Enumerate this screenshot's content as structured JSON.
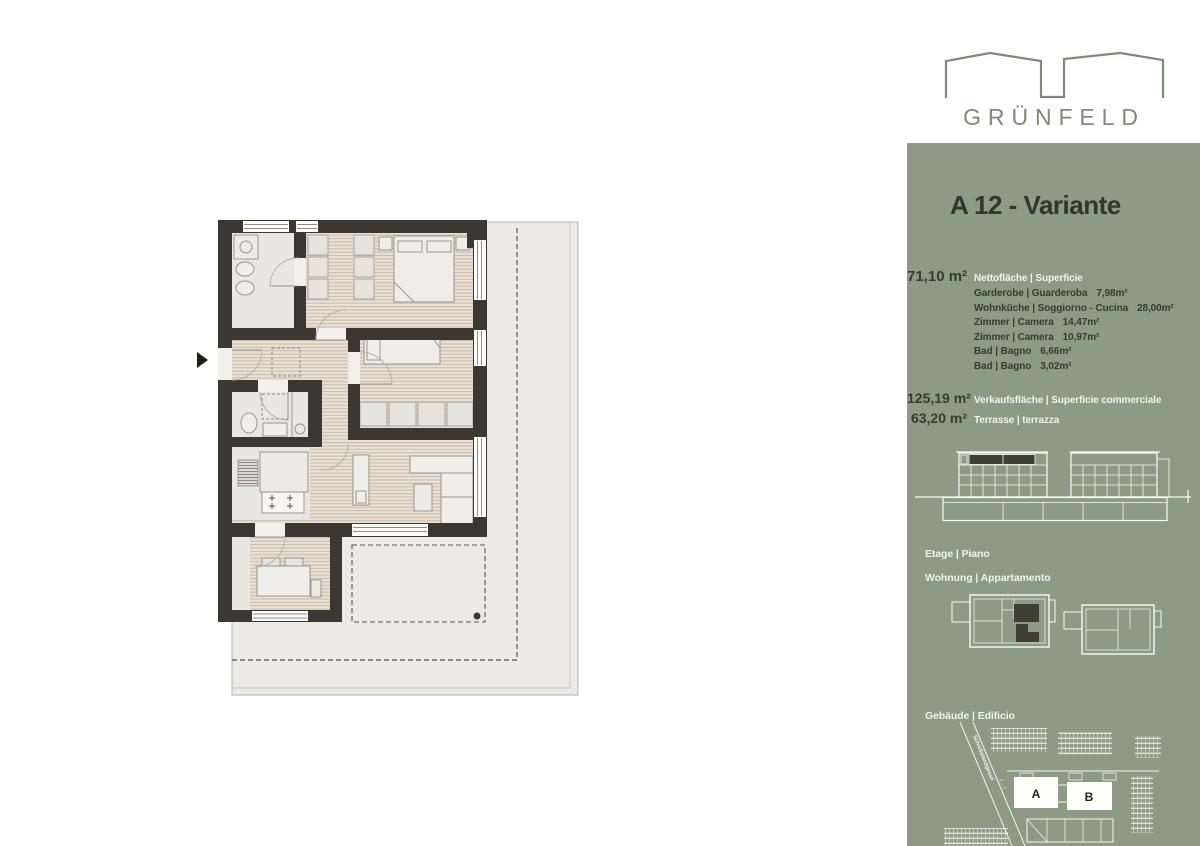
{
  "brand": {
    "name": "GRÜNFELD"
  },
  "panel": {
    "title": "A 12 - Variante",
    "net": {
      "value": "71,10 m²",
      "label": "Nettofläche | Superficie"
    },
    "rooms": [
      {
        "label": "Garderobe | Guarderoba",
        "value": "7,98m²"
      },
      {
        "label": "Wohnküche | Soggiorno - Cucina",
        "value": "28,00m²"
      },
      {
        "label": "Zimmer | Camera",
        "value": "14,47m²"
      },
      {
        "label": "Zimmer | Camera",
        "value": "10,97m²"
      },
      {
        "label": "Bad | Bagno",
        "value": "6,66m²"
      },
      {
        "label": "Bad | Bagno",
        "value": "3,02m²"
      }
    ],
    "sales": {
      "value": "125,19 m²",
      "label": "Verkaufsfläche | Superficie commerciale"
    },
    "terrace": {
      "value": "63,20 m²",
      "label": "Terrasse | terrazza"
    },
    "sections": {
      "floor": "Etage | Piano",
      "apartment": "Wohnung | Appartamento",
      "building": "Gebäude | Edificio"
    },
    "siteplan": {
      "building_a": "A",
      "building_b": "B",
      "street": "Schießstandgasse",
      "street_note": "( ... )"
    }
  },
  "colors": {
    "panel_bg": "#8C9A86",
    "logo_green": "#7B8D74",
    "text_dark": "#3A3A31",
    "text_white": "#F2F3EC",
    "wall": "#3B3833",
    "highlight_dark": "#3F3E37"
  }
}
